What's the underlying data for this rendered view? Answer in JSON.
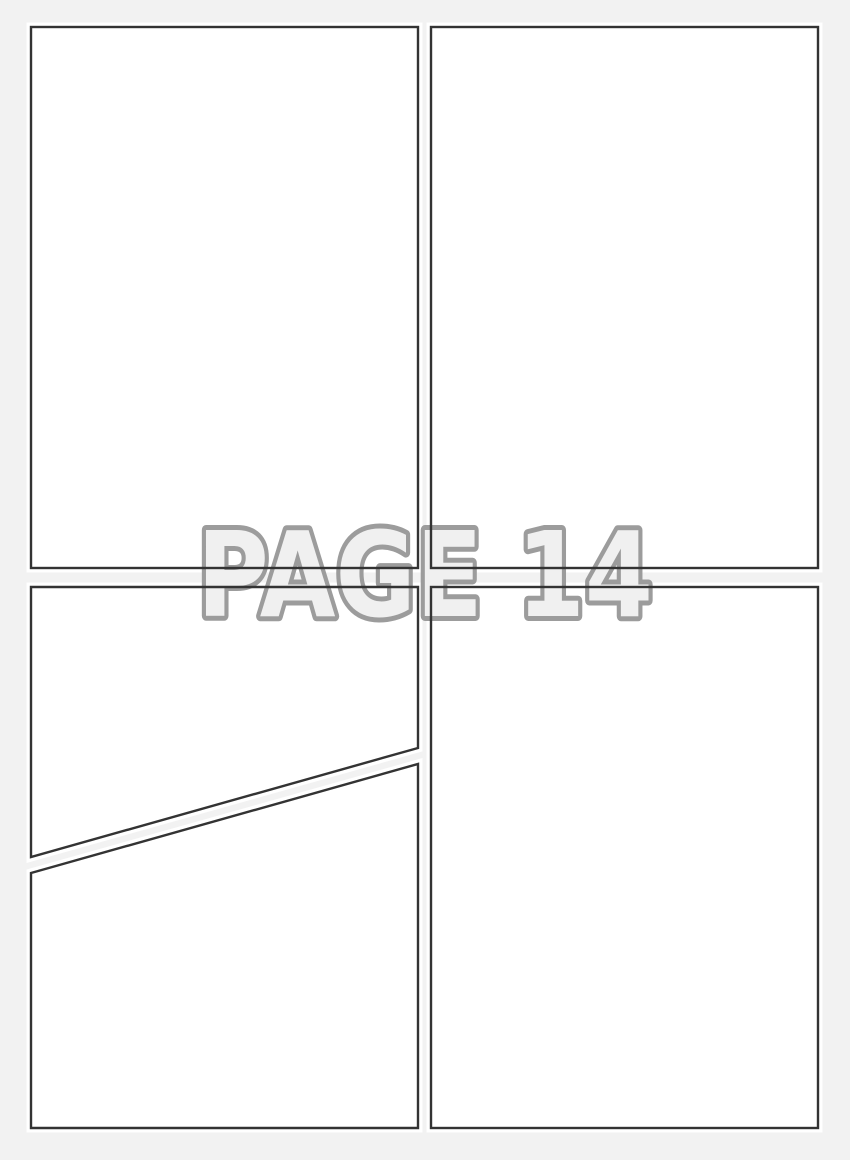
{
  "watermark": {
    "label": "PAGE 14"
  },
  "panels": [
    {
      "id": "panel-1",
      "position": "top-left",
      "content": ""
    },
    {
      "id": "panel-2",
      "position": "top-right",
      "content": ""
    },
    {
      "id": "panel-3",
      "position": "middle-left-above-diagonal",
      "content": ""
    },
    {
      "id": "panel-4",
      "position": "bottom-left-below-diagonal",
      "content": ""
    },
    {
      "id": "panel-5",
      "position": "bottom-right",
      "content": ""
    }
  ],
  "colors": {
    "background": "#f2f2f2",
    "panel_fill": "#ffffff",
    "panel_halo": "#ffffff",
    "panel_border": "#333333",
    "watermark_fill": "#f0f0f0",
    "watermark_outline": "#9c9c9c"
  }
}
